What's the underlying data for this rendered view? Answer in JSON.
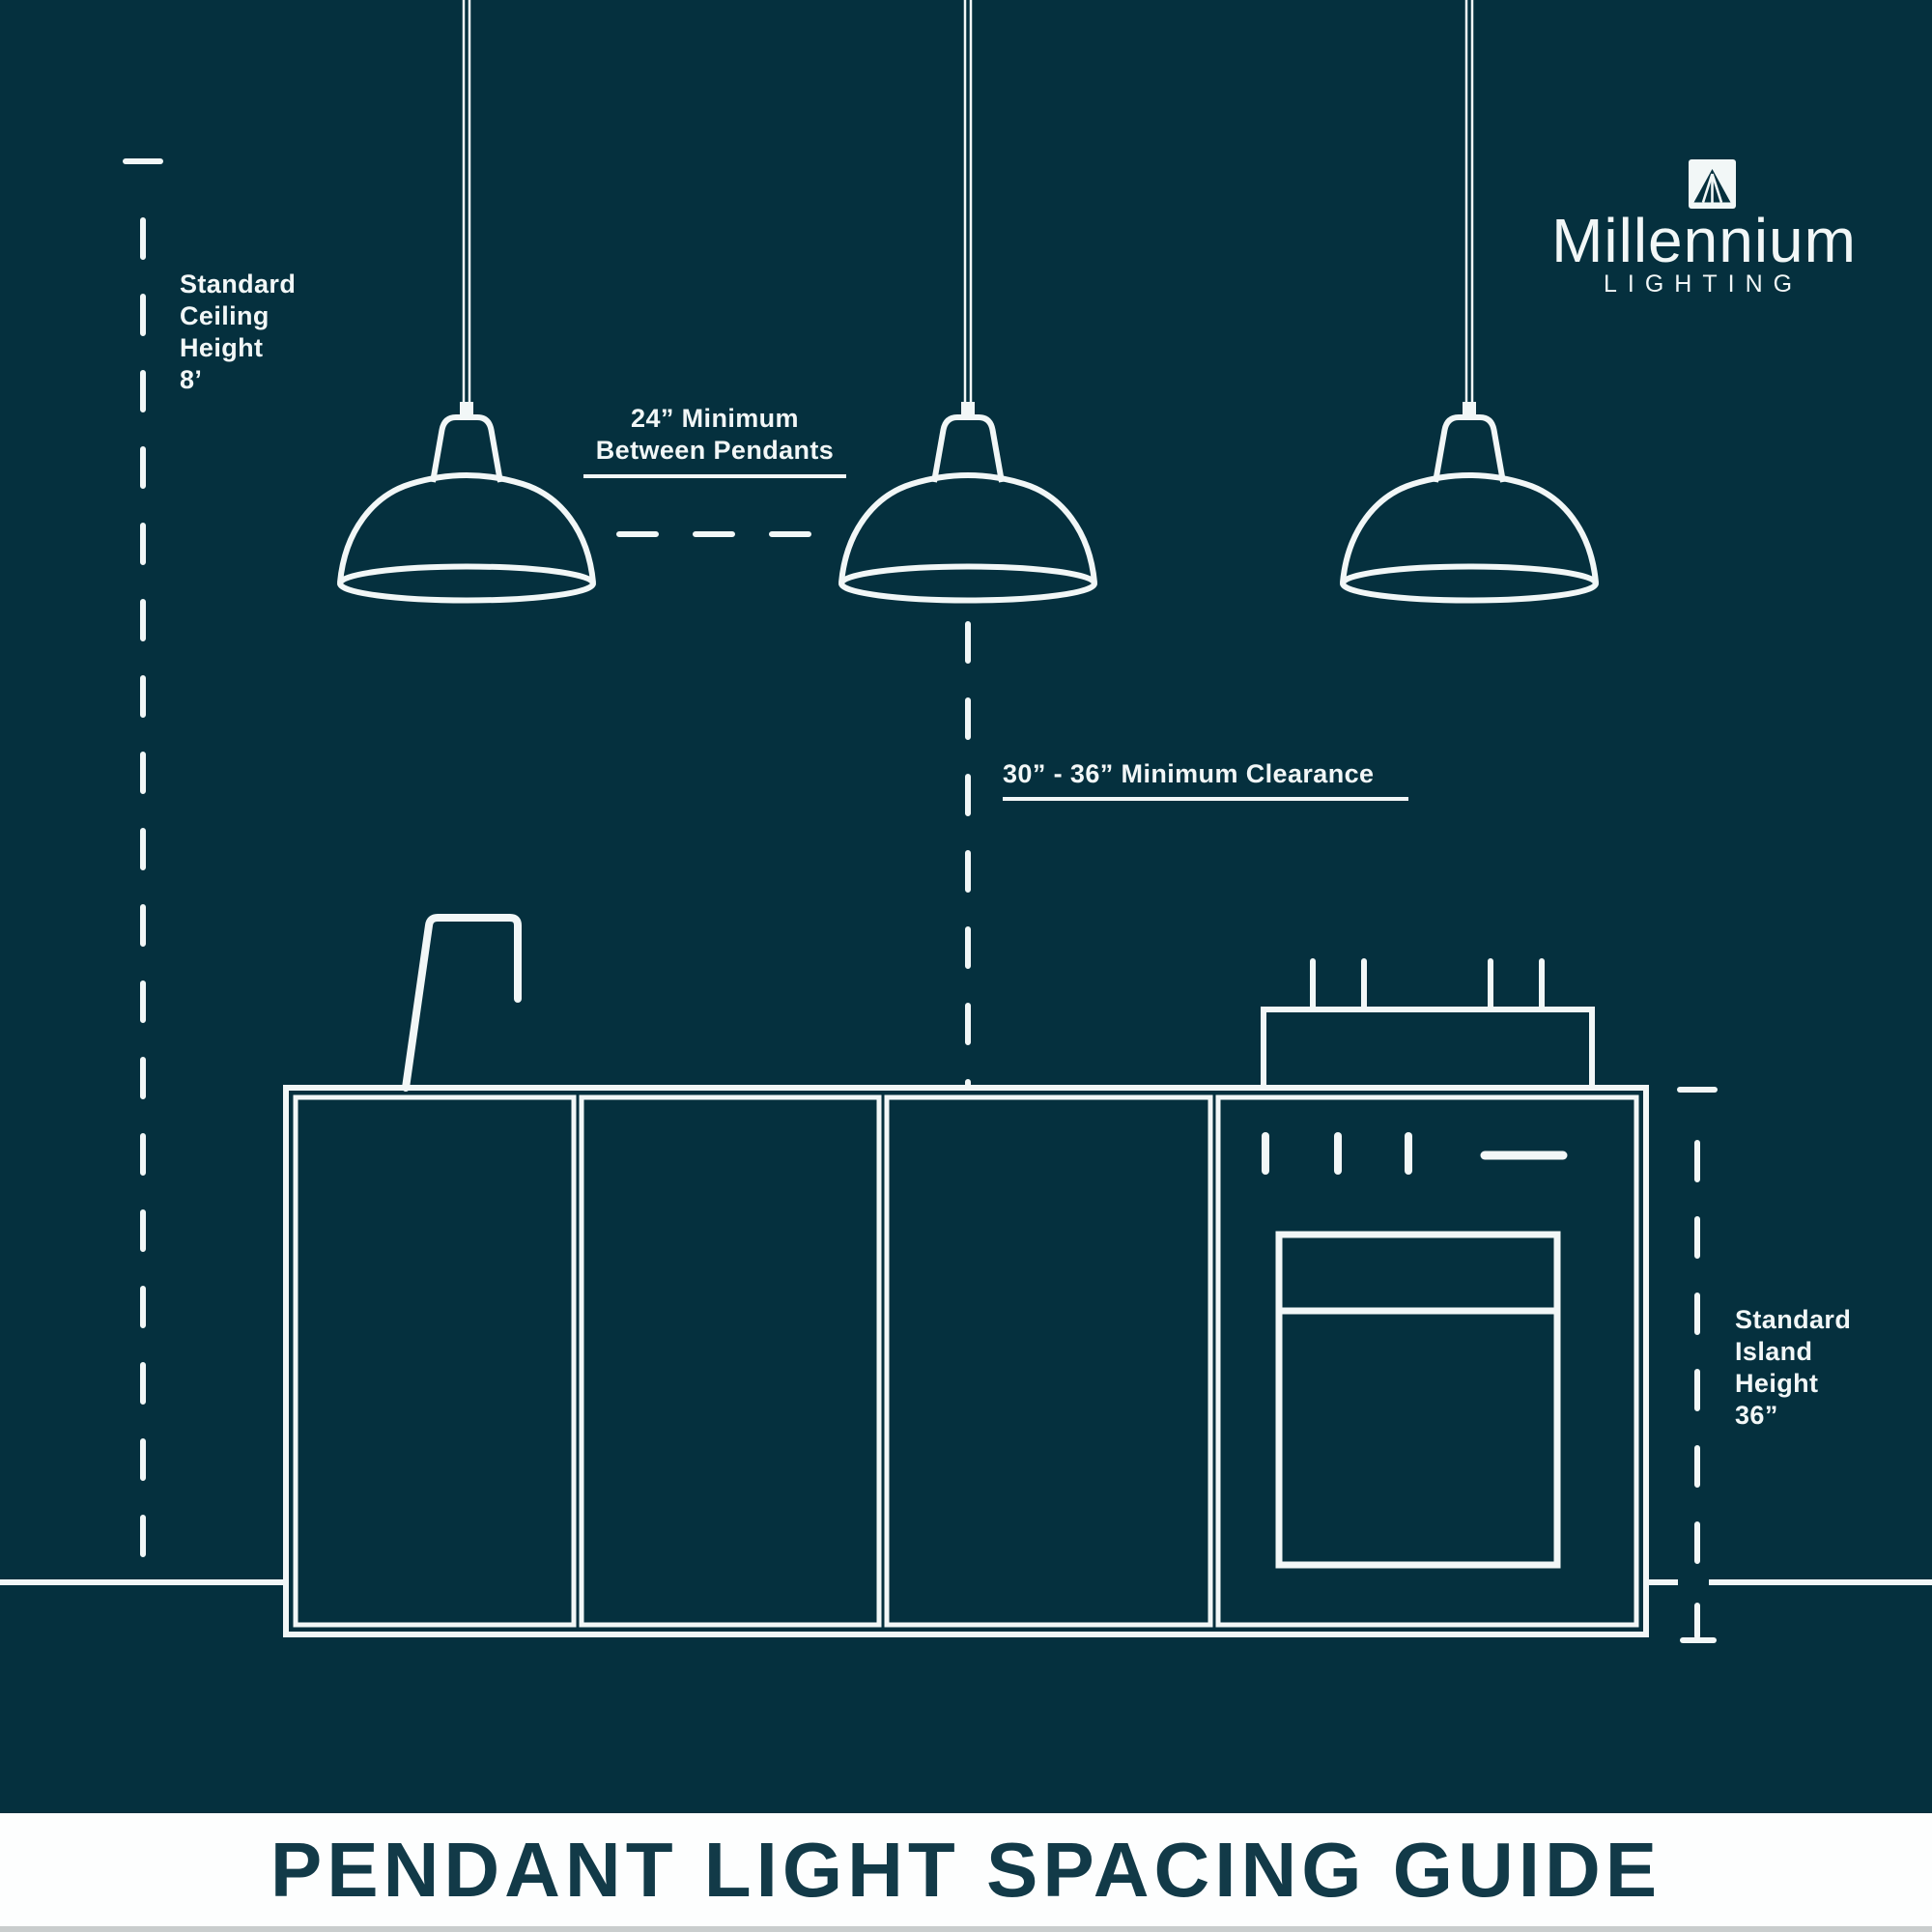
{
  "colors": {
    "background": "#05303e",
    "line": "#f2f7f7",
    "banner_background": "#fdfefe",
    "banner_text": "#123a48",
    "footer_strip": "#c9cdcd"
  },
  "logo": {
    "icon": "millennium-mountain-lamp-icon",
    "name": "Millennium",
    "subtitle": "LIGHTING"
  },
  "annotations": {
    "ceiling": {
      "lines": [
        "Standard",
        "Ceiling",
        "Height",
        "8’"
      ]
    },
    "between": {
      "lines": [
        "24” Minimum",
        "Between Pendants"
      ]
    },
    "clearance": {
      "text": "30” - 36” Minimum Clearance"
    },
    "island": {
      "lines": [
        "Standard",
        "Island",
        "Height",
        "36”"
      ]
    }
  },
  "banner": {
    "title": "PENDANT LIGHT SPACING GUIDE"
  }
}
